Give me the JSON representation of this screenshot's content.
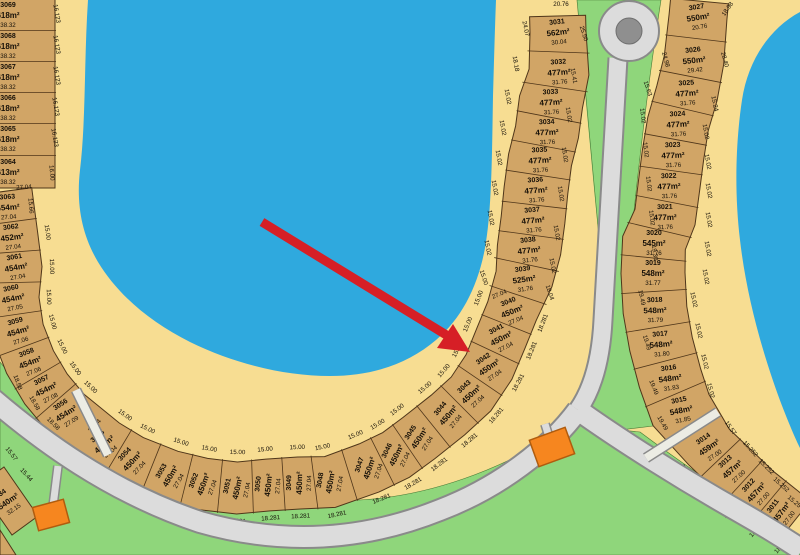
{
  "map_title": "Subdivision plat map with lake, lots and roundabout",
  "colors": {
    "water": "#2fa9de",
    "sand": "#f7dd92",
    "green": "#8fd67b",
    "lot_fill": "#d1a566",
    "lot_stroke": "#4f361a",
    "road_fill": "#dcdcdc",
    "road_casing": "#8a8a8a",
    "walkway_fill": "#ecece4",
    "roundabout_island": "#8f8f8f",
    "building": "#f6861f",
    "building_stroke": "#b05c0e",
    "arrow": "#d61f26",
    "text": "#161008"
  },
  "chains": [
    {
      "name": "left-column",
      "front_dim_text": "15.00",
      "back_dim_text": "18.281",
      "lots": [
        {
          "n": "3069",
          "a": "618m²",
          "d": "38.32",
          "x": 8,
          "y": 15,
          "r": 0,
          "hd": 47,
          "f": 0,
          "b": 0
        },
        {
          "n": "3068",
          "a": "618m²",
          "d": "38.32",
          "x": 8,
          "y": 46,
          "r": 0,
          "hd": 47,
          "f": 0,
          "b": 0
        },
        {
          "n": "3067",
          "a": "618m²",
          "d": "38.32",
          "x": 8,
          "y": 77,
          "r": 0,
          "hd": 47,
          "f": 0,
          "b": 0
        },
        {
          "n": "3066",
          "a": "618m²",
          "d": "38.32",
          "x": 8,
          "y": 108,
          "r": 0,
          "hd": 47,
          "f": 0,
          "b": 0
        },
        {
          "n": "3065",
          "a": "618m²",
          "d": "38.32",
          "x": 8,
          "y": 139,
          "r": 0,
          "hd": 47,
          "f": 0,
          "b": 0
        },
        {
          "n": "3064",
          "a": "613m²",
          "d": "38.32",
          "x": 8,
          "y": 172,
          "r": 0,
          "hd": 47,
          "f": 0,
          "b": 0
        }
      ],
      "gaps": []
    },
    {
      "name": "lake-curve-and-middle-column",
      "front_dim_text": "15.00",
      "back_dim_text": "18.281",
      "lots": [
        {
          "n": "3063",
          "a": "454m²",
          "d": "27.04",
          "x": 8,
          "y": 207,
          "r": -4,
          "hd": 26,
          "f": 0,
          "b": 0
        },
        {
          "n": "3062",
          "a": "452m²",
          "d": "27.04",
          "x": 12,
          "y": 237,
          "r": -7,
          "hd": 26,
          "f": 1,
          "b": 0
        },
        {
          "n": "3061",
          "a": "454m²",
          "d": "27.04",
          "x": 16,
          "y": 267,
          "r": -10,
          "hd": 26,
          "f": 1,
          "b": 0
        },
        {
          "n": "3060",
          "a": "454m²",
          "d": "27.05",
          "x": 13,
          "y": 298,
          "r": -12,
          "hd": 26,
          "f": 1,
          "b": 0
        },
        {
          "n": "3059",
          "a": "454m²",
          "d": "27.06",
          "x": 18,
          "y": 331,
          "r": -16,
          "hd": 26,
          "f": 1,
          "b": 0
        },
        {
          "n": "3058",
          "a": "454m²",
          "d": "27.06",
          "x": 30,
          "y": 362,
          "r": -21,
          "hd": 26,
          "f": 1,
          "b": 0
        },
        {
          "n": "3057",
          "a": "454m²",
          "d": "27.08",
          "x": 46,
          "y": 389,
          "r": -27,
          "hd": 26,
          "f": 1,
          "b": 0
        },
        {
          "n": "3056",
          "a": "454m²",
          "d": "27.09",
          "x": 66,
          "y": 413,
          "r": -33,
          "hd": 26,
          "f": 1,
          "b": 0
        },
        {
          "n": "3055",
          "a": "450m²",
          "d": "27.04",
          "x": 104,
          "y": 444,
          "r": -40,
          "hd": 26,
          "f": 1,
          "b": 1
        },
        {
          "n": "3054",
          "a": "450m²",
          "d": "27.04",
          "x": 132,
          "y": 461,
          "r": -47,
          "hd": 26,
          "f": 1,
          "b": 1
        },
        {
          "n": "3053",
          "a": "450m²",
          "d": "27.04",
          "x": 170,
          "y": 476,
          "r": -60,
          "hd": 26,
          "f": 1,
          "b": 1
        },
        {
          "n": "3052",
          "a": "450m²",
          "d": "27.04",
          "x": 203,
          "y": 484,
          "r": -70,
          "hd": 26,
          "f": 1,
          "b": 1
        },
        {
          "n": "3051",
          "a": "450m²",
          "d": "27.04",
          "x": 237,
          "y": 488,
          "r": -78,
          "hd": 26,
          "f": 1,
          "b": 1
        },
        {
          "n": "3050",
          "a": "450m²",
          "d": "27.04",
          "x": 268,
          "y": 485,
          "r": -84,
          "hd": 26,
          "f": 1,
          "b": 1
        },
        {
          "n": "3049",
          "a": "450m²",
          "d": "27.04",
          "x": 299,
          "y": 483,
          "r": -89,
          "hd": 26,
          "f": 1,
          "b": 1
        },
        {
          "n": "3048",
          "a": "450m²",
          "d": "27.04",
          "x": 330,
          "y": 482,
          "r": -80,
          "hd": 26,
          "f": 1,
          "b": 1
        },
        {
          "n": "3047",
          "a": "450m²",
          "d": "27.04",
          "x": 369,
          "y": 468,
          "r": -72,
          "hd": 26,
          "f": 1,
          "b": 1
        },
        {
          "n": "3046",
          "a": "450m²",
          "d": "27.04",
          "x": 396,
          "y": 455,
          "r": -64,
          "hd": 26,
          "f": 1,
          "b": 1
        },
        {
          "n": "3045",
          "a": "450m²",
          "d": "27.04",
          "x": 419,
          "y": 438,
          "r": -57,
          "hd": 26,
          "f": 1,
          "b": 1
        },
        {
          "n": "3044",
          "a": "450m²",
          "d": "27.04",
          "x": 448,
          "y": 415,
          "r": -50,
          "hd": 26,
          "f": 1,
          "b": 1
        },
        {
          "n": "3043",
          "a": "450m²",
          "d": "27.04",
          "x": 471,
          "y": 394,
          "r": -43,
          "hd": 26,
          "f": 1,
          "b": 1
        },
        {
          "n": "3042",
          "a": "450m²",
          "d": "27.04",
          "x": 489,
          "y": 367,
          "r": -35,
          "hd": 26,
          "f": 1,
          "b": 1
        },
        {
          "n": "3041",
          "a": "450m²",
          "d": "27.04",
          "x": 501,
          "y": 338,
          "r": -28,
          "hd": 26,
          "f": 1,
          "b": 1
        },
        {
          "n": "3040",
          "a": "450m²",
          "d": "27.04",
          "x": 512,
          "y": 311,
          "r": -22,
          "hd": 26,
          "f": 1,
          "b": 1
        },
        {
          "n": "3039",
          "a": "525m²",
          "d": "31.76",
          "x": 524,
          "y": 279,
          "r": -8,
          "hd": 29,
          "f": 0,
          "b": 0
        },
        {
          "n": "3038",
          "a": "477m²",
          "d": "31.76",
          "x": 529,
          "y": 250,
          "r": -6,
          "hd": 32,
          "f": 0,
          "b": 0
        },
        {
          "n": "3037",
          "a": "477m²",
          "d": "31.76",
          "x": 533,
          "y": 220,
          "r": -5,
          "hd": 32,
          "f": 0,
          "b": 0
        },
        {
          "n": "3036",
          "a": "477m²",
          "d": "31.76",
          "x": 536,
          "y": 190,
          "r": -4,
          "hd": 32,
          "f": 0,
          "b": 0
        },
        {
          "n": "3035",
          "a": "477m²",
          "d": "31.76",
          "x": 540,
          "y": 160,
          "r": -3,
          "hd": 32,
          "f": 0,
          "b": 0
        },
        {
          "n": "3034",
          "a": "477m²",
          "d": "31.76",
          "x": 547,
          "y": 132,
          "r": -2,
          "hd": 32,
          "f": 0,
          "b": 0
        },
        {
          "n": "3033",
          "a": "477m²",
          "d": "31.76",
          "x": 551,
          "y": 102,
          "r": -3,
          "hd": 32,
          "f": 0,
          "b": 0
        },
        {
          "n": "3032",
          "a": "477m²",
          "d": "31.76",
          "x": 559,
          "y": 72,
          "r": -4,
          "hd": 30,
          "f": 0,
          "b": 0
        },
        {
          "n": "3031",
          "a": "562m²",
          "d": "30.04",
          "x": 558,
          "y": 32,
          "r": -6,
          "hd": 28,
          "f": 0,
          "b": 0
        }
      ],
      "gaps": [
        7
      ]
    },
    {
      "name": "right-column",
      "front_dim_text": "15.02",
      "back_dim_text": "19.49",
      "lots": [
        {
          "n": "3027",
          "a": "550m²",
          "d": "20.76",
          "x": 698,
          "y": 17,
          "r": -9,
          "hd": 29,
          "f": 0,
          "b": 0
        },
        {
          "n": "3026",
          "a": "550m²",
          "d": "29.42",
          "x": 694,
          "y": 60,
          "r": -6,
          "hd": 30,
          "f": 0,
          "b": 0
        },
        {
          "n": "3025",
          "a": "477m²",
          "d": "31.76",
          "x": 687,
          "y": 93,
          "r": -4,
          "hd": 31,
          "f": 0,
          "b": 0
        },
        {
          "n": "3024",
          "a": "477m²",
          "d": "31.76",
          "x": 678,
          "y": 124,
          "r": -3,
          "hd": 31,
          "f": 0,
          "b": 0
        },
        {
          "n": "3023",
          "a": "477m²",
          "d": "31.76",
          "x": 673,
          "y": 155,
          "r": -2,
          "hd": 31,
          "f": 0,
          "b": 0
        },
        {
          "n": "3022",
          "a": "477m²",
          "d": "31.76",
          "x": 669,
          "y": 186,
          "r": -2,
          "hd": 31,
          "f": 0,
          "b": 0
        },
        {
          "n": "3021",
          "a": "477m²",
          "d": "31.76",
          "x": 665,
          "y": 217,
          "r": -1,
          "hd": 31,
          "f": 0,
          "b": 0
        },
        {
          "n": "3020",
          "a": "545m²",
          "d": "31.76",
          "x": 654,
          "y": 243,
          "r": 0,
          "hd": 32,
          "f": 0,
          "b": 0
        },
        {
          "n": "3019",
          "a": "548m²",
          "d": "31.77",
          "x": 653,
          "y": 273,
          "r": 0,
          "hd": 32,
          "f": 0,
          "b": 0
        },
        {
          "n": "3018",
          "a": "548m²",
          "d": "31.79",
          "x": 655,
          "y": 310,
          "r": -2,
          "hd": 32,
          "f": 0,
          "b": 0
        },
        {
          "n": "3017",
          "a": "548m²",
          "d": "31.80",
          "x": 661,
          "y": 344,
          "r": -5,
          "hd": 32,
          "f": 0,
          "b": 0
        },
        {
          "n": "3016",
          "a": "548m²",
          "d": "31.83",
          "x": 670,
          "y": 378,
          "r": -8,
          "hd": 32,
          "f": 0,
          "b": 0
        },
        {
          "n": "3015",
          "a": "548m²",
          "d": "31.85",
          "x": 681,
          "y": 410,
          "r": -12,
          "hd": 32,
          "f": 0,
          "b": 0
        },
        {
          "n": "3014",
          "a": "459m²",
          "d": "27.00",
          "x": 709,
          "y": 447,
          "r": -35,
          "hd": 27,
          "f": 0,
          "b": 0
        },
        {
          "n": "3013",
          "a": "457m²",
          "d": "27.00",
          "x": 732,
          "y": 469,
          "r": -42,
          "hd": 27,
          "f": 0,
          "b": 0
        },
        {
          "n": "3012",
          "a": "457m²",
          "d": "27.00",
          "x": 756,
          "y": 492,
          "r": -48,
          "hd": 27,
          "f": 0,
          "b": 0
        },
        {
          "n": "3011",
          "a": "457m²",
          "d": "27.00",
          "x": 781,
          "y": 512,
          "r": -53,
          "hd": 27,
          "f": 0,
          "b": 0
        }
      ],
      "gaps": [
        12
      ]
    }
  ],
  "corner_lot": {
    "lines": [
      "34",
      "540m²",
      "32.15"
    ],
    "cx": 8,
    "cy": 501,
    "rot": -35,
    "pts": "4,467 38,516 12,535 -22,486"
  },
  "side_dims": [
    [
      "16.123",
      55,
      14,
      80
    ],
    [
      "16.123",
      55,
      45,
      80
    ],
    [
      "16.123",
      55,
      76,
      80
    ],
    [
      "16.123",
      54,
      107,
      80
    ],
    [
      "16.123",
      53,
      138,
      80
    ],
    [
      "16.00",
      50,
      173,
      85
    ],
    [
      "27.04",
      24,
      189,
      -3
    ],
    [
      "15.66",
      29,
      206,
      85
    ],
    [
      "18.58",
      16,
      383,
      70
    ],
    [
      "18.58",
      33,
      404,
      60
    ],
    [
      "18.58",
      52,
      425,
      45
    ],
    [
      "27.04",
      96,
      427,
      -47
    ],
    [
      "24.07",
      524,
      29,
      78
    ],
    [
      "18.18",
      514,
      64,
      80
    ],
    [
      "15.02",
      506,
      97,
      80
    ],
    [
      "15.02",
      501,
      128,
      80
    ],
    [
      "15.02",
      497,
      158,
      80
    ],
    [
      "15.02",
      493,
      188,
      80
    ],
    [
      "15.02",
      489,
      218,
      80
    ],
    [
      "15.02",
      486,
      248,
      79
    ],
    [
      "15.00",
      482,
      278,
      72
    ],
    [
      "20.76",
      561,
      6,
      0
    ],
    [
      "25.50",
      582,
      34,
      72
    ],
    [
      "15.41",
      572,
      76,
      80
    ],
    [
      "15.02",
      567,
      115,
      81
    ],
    [
      "15.02",
      563,
      155,
      81
    ],
    [
      "15.02",
      559,
      194,
      81
    ],
    [
      "15.02",
      555,
      233,
      80
    ],
    [
      "15.02",
      551,
      266,
      79
    ],
    [
      "18.04",
      548,
      293,
      72
    ],
    [
      "27.04",
      500,
      296,
      -22
    ],
    [
      "24.98",
      664,
      60,
      75
    ],
    [
      "15.63",
      646,
      89,
      72
    ],
    [
      "18.98",
      729,
      10,
      -55
    ],
    [
      "28.40",
      723,
      60,
      75
    ],
    [
      "15.24",
      713,
      104,
      78
    ],
    [
      "15.02",
      641,
      116,
      83
    ],
    [
      "15.02",
      644,
      150,
      83
    ],
    [
      "15.02",
      647,
      184,
      83
    ],
    [
      "15.02",
      650,
      218,
      83
    ],
    [
      "19.30",
      653,
      253,
      82
    ],
    [
      "19.49",
      640,
      298,
      78
    ],
    [
      "19.49",
      645,
      343,
      74
    ],
    [
      "19.49",
      652,
      388,
      68
    ],
    [
      "19.49",
      661,
      424,
      60
    ],
    [
      "15.02",
      704,
      132,
      80
    ],
    [
      "15.02",
      706,
      162,
      80
    ],
    [
      "15.02",
      707,
      191,
      80
    ],
    [
      "15.02",
      707,
      220,
      80
    ],
    [
      "15.02",
      706,
      249,
      80
    ],
    [
      "15.02",
      704,
      277,
      80
    ],
    [
      "15.02",
      692,
      300,
      78
    ],
    [
      "15.02",
      697,
      331,
      78
    ],
    [
      "15.02",
      703,
      362,
      77
    ],
    [
      "15.02",
      709,
      391,
      76
    ],
    [
      "15.57",
      729,
      429,
      55
    ],
    [
      "15.252",
      749,
      450,
      48
    ],
    [
      "15.252",
      765,
      468,
      45
    ],
    [
      "15.252",
      780,
      486,
      42
    ],
    [
      "15.25",
      793,
      503,
      40
    ],
    [
      "18.42",
      681,
      472,
      -38
    ],
    [
      "18.60",
      706,
      492,
      -42
    ],
    [
      "18.60",
      731,
      513,
      -45
    ],
    [
      "18.60",
      757,
      532,
      -47
    ],
    [
      "18.60",
      782,
      548,
      -49
    ],
    [
      "27.00",
      692,
      430,
      -22
    ],
    [
      "15.57",
      10,
      455,
      52
    ],
    [
      "15.44",
      25,
      476,
      48
    ]
  ],
  "arrow": {
    "x1": 262,
    "y1": 222,
    "x2": 448,
    "y2": 336,
    "tip": "470,352 437,348 453,324"
  },
  "landmarks": {
    "roundabout": {
      "cx": 629,
      "cy": 31,
      "r_outer": 30,
      "r_island": 13
    },
    "building_1": {
      "cx": 552,
      "cy": 447,
      "w": 38,
      "h": 28,
      "rot": -20
    },
    "building_2": {
      "cx": 51,
      "cy": 515,
      "w": 32,
      "h": 24,
      "rot": -15
    }
  }
}
